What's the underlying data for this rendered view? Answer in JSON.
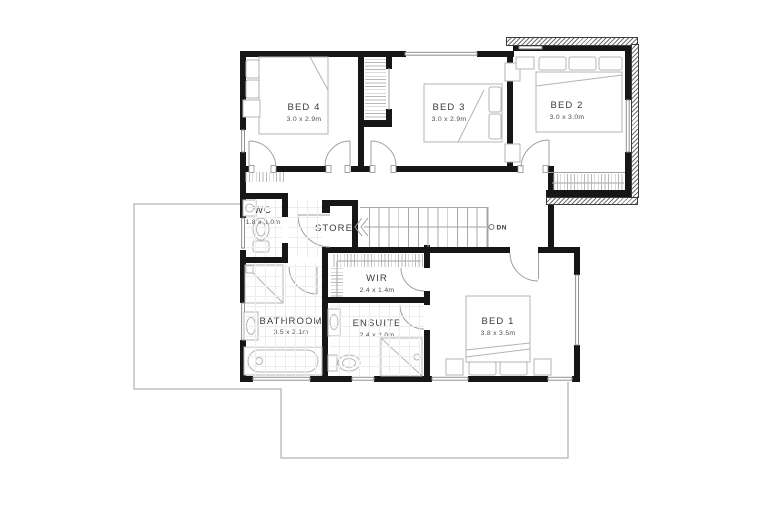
{
  "colors": {
    "wall": "#161616",
    "fixture": "#b4b4b4",
    "door": "#9f9f9f",
    "window": "#8f8f8f",
    "text": "#3a3a3a",
    "dim_text": "#4f4f4f",
    "lower_floor_outline": "#b5b5b5",
    "stair_detail": "#a0a0a0"
  },
  "rooms": {
    "bed4": {
      "name": "BED 4",
      "dims": "3.0 x 2.9m"
    },
    "bed3": {
      "name": "BED 3",
      "dims": "3.0 x 2.9m"
    },
    "bed2": {
      "name": "BED 2",
      "dims": "3.0 x 3.0m"
    },
    "bed1": {
      "name": "BED 1",
      "dims": "3.8 x 3.5m"
    },
    "wc": {
      "name": "WC",
      "dims": "1.8 x 1.0m"
    },
    "store": {
      "name": "STORE"
    },
    "wir": {
      "name": "WIR",
      "dims": "2.4 x 1.4m"
    },
    "bathroom": {
      "name": "BATHROOM",
      "dims": "3.5 x 2.1m"
    },
    "ensuite": {
      "name": "ENSUITE",
      "dims": "2.4 x 2.0m"
    }
  },
  "stairs": {
    "label": "DN"
  }
}
